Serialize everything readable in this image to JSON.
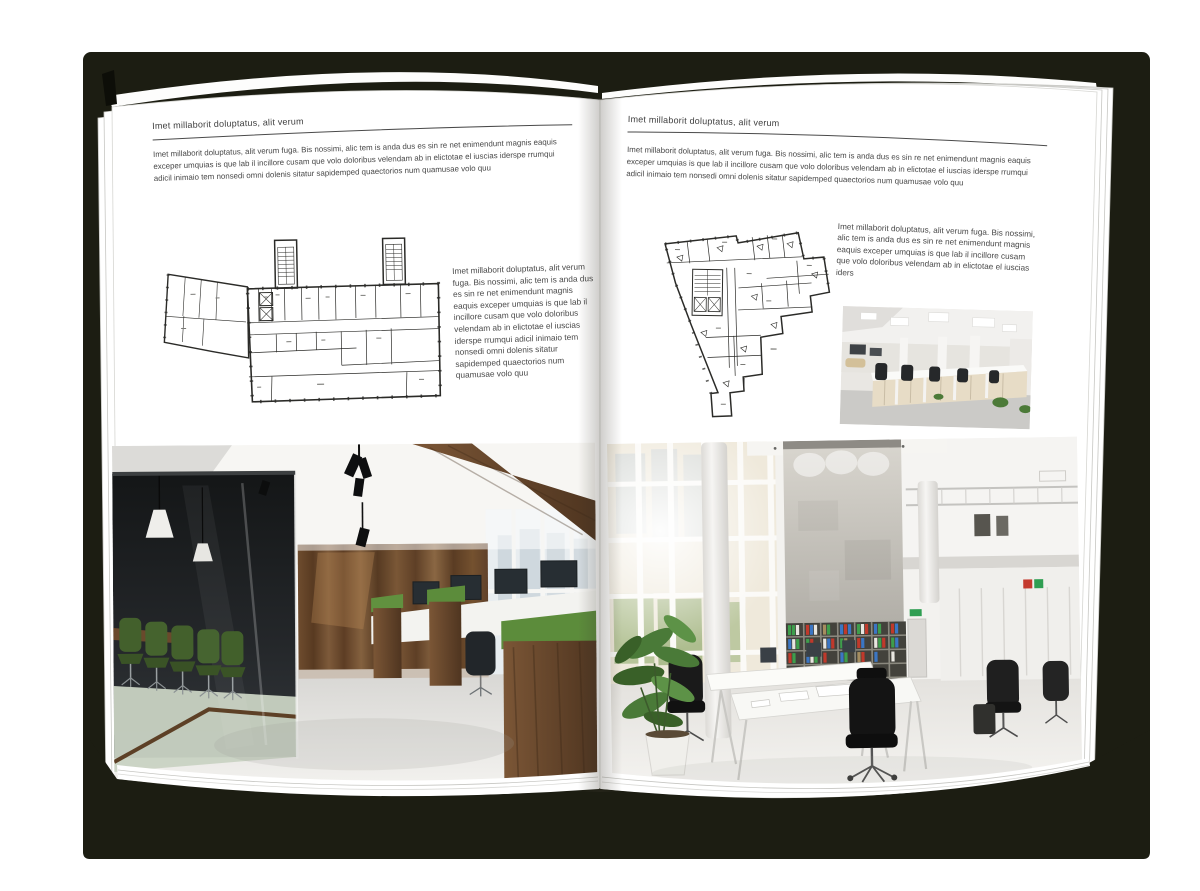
{
  "palette": {
    "backdrop": "#1c1d12",
    "page": "#ffffff",
    "text": "#484848",
    "rule": "#4a4a4a",
    "plan_ink": "#2b2b28",
    "wood": "#6a4830",
    "chair_green": "#43602c",
    "binder_green": "#3e9e4c",
    "binder_red": "#c0392b",
    "binder_blue": "#3b76c4"
  },
  "left_page": {
    "header": "Imet millaborit doluptatus, alit verum",
    "intro": "Imet millaborit doluptatus, alit verum fuga. Bis nossimi, alic tem is anda dus es sin re net enimendunt magnis eaquis exceper umquias is que lab il incillore cusam que volo doloribus velendam ab in elictotae el iuscias iderspe rrumqui adicil inimaio tem nonsedi omni dolenis sitatur sapidemped quaectorios num quamusae volo quu",
    "side_text": "Imet millaborit doluptatus, alit verum fuga. Bis nossimi, alic tem is anda dus es sin re net enimendunt magnis eaquis exceper umquias is que lab il incillore cusam que volo doloribus velendam ab in elictotae el iuscias iderspe rrumqui adicil inimaio tem nonsedi omni dolenis sitatur sapidemped quaectorios num quamusae volo quu"
  },
  "right_page": {
    "header": "Imet millaborit doluptatus, alit verum",
    "intro": "Imet millaborit doluptatus, alit verum fuga. Bis nossimi, alic tem is anda dus es sin re net enimendunt magnis eaquis exceper umquias is que lab il incillore cusam que volo doloribus velendam ab in elictotae el iuscias iderspe rrumqui adicil inimaio tem nonsedi omni dolenis sitatur sapidemped quaectorios num quamusae volo quu",
    "side_text": "Imet millaborit doluptatus, alit verum fuga. Bis nossimi, alic tem is anda dus es sin re net enimendunt magnis eaquis exceper umquias is que lab il incillore cusam que volo doloribus velendam ab in elictotae el iuscias iders"
  }
}
